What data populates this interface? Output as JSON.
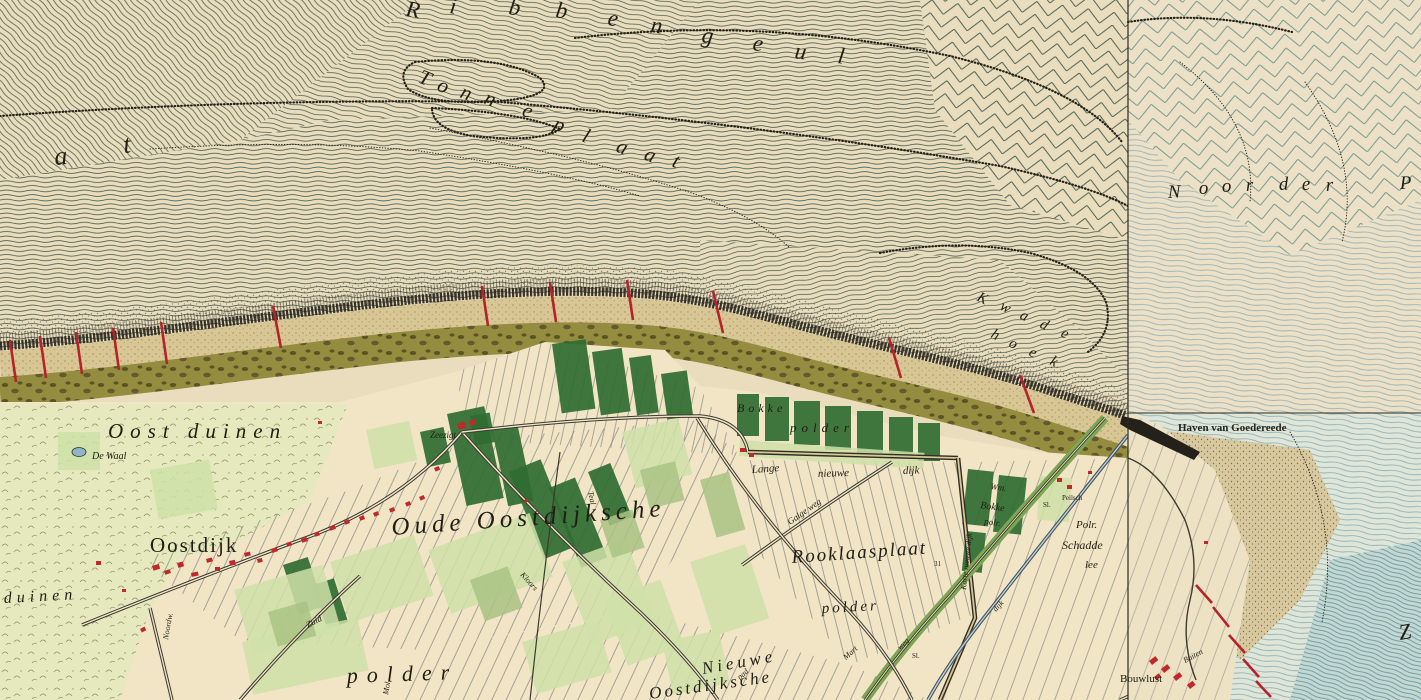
{
  "map": {
    "colors": {
      "paper_sea": "#e9ddbd",
      "paper_right": "#ece0c6",
      "paper_polder": "#f1e5c6",
      "sea_line": "#3a4f47",
      "chevron_right": "#5d8c82",
      "water_blue": "#7fa7b4",
      "water_deep": "#5e94a6",
      "beach": "#d9c695",
      "olive_band": "#948c3e",
      "dune_pale": "#e5e9bd",
      "field_dark": "#2f6c31",
      "field_mid": "#a9c383",
      "field_light": "#cfe0a8",
      "building_red": "#c0282a",
      "groyne_red": "#b5232a",
      "road_dark": "#3b3a30",
      "ink": "#201e13"
    },
    "sea_words": [
      {
        "name": "ribbengeul",
        "size": 23,
        "rot": 8,
        "letters": [
          {
            "t": "R",
            "x": 405,
            "y": 16
          },
          {
            "t": "i",
            "x": 449,
            "y": 13
          },
          {
            "t": "b",
            "x": 508,
            "y": 14
          },
          {
            "t": "b",
            "x": 555,
            "y": 17
          },
          {
            "t": "e",
            "x": 607,
            "y": 25
          },
          {
            "t": "n",
            "x": 650,
            "y": 32
          },
          {
            "t": "g",
            "x": 701,
            "y": 42
          },
          {
            "t": "e",
            "x": 752,
            "y": 50
          },
          {
            "t": "u",
            "x": 794,
            "y": 58
          },
          {
            "t": "l",
            "x": 837,
            "y": 63
          }
        ]
      },
      {
        "name": "tonneplaat",
        "size": 21,
        "rot": 22,
        "letters": [
          {
            "t": "T",
            "x": 417,
            "y": 82
          },
          {
            "t": "o",
            "x": 436,
            "y": 90
          },
          {
            "t": "n",
            "x": 459,
            "y": 97
          },
          {
            "t": "n",
            "x": 483,
            "y": 103
          },
          {
            "t": "e",
            "x": 521,
            "y": 115
          },
          {
            "t": "p",
            "x": 552,
            "y": 129
          },
          {
            "t": "l",
            "x": 581,
            "y": 141
          },
          {
            "t": "a",
            "x": 615,
            "y": 151
          },
          {
            "t": "a",
            "x": 643,
            "y": 159
          },
          {
            "t": "t",
            "x": 671,
            "y": 166
          }
        ]
      },
      {
        "name": "plaat-at",
        "size": 26,
        "rot": -5,
        "letters": [
          {
            "t": "a",
            "x": 55,
            "y": 165
          },
          {
            "t": "t",
            "x": 124,
            "y": 153
          }
        ]
      },
      {
        "name": "noorder-p",
        "size": 19,
        "rot": -2,
        "letters": [
          {
            "t": "N",
            "x": 1168,
            "y": 198
          },
          {
            "t": "o",
            "x": 1199,
            "y": 194
          },
          {
            "t": "o",
            "x": 1222,
            "y": 192
          },
          {
            "t": "r",
            "x": 1246,
            "y": 191
          },
          {
            "t": "d",
            "x": 1279,
            "y": 190
          },
          {
            "t": "e",
            "x": 1302,
            "y": 190
          },
          {
            "t": "r",
            "x": 1326,
            "y": 191
          },
          {
            "t": "P",
            "x": 1400,
            "y": 189
          }
        ]
      },
      {
        "name": "kwade-hoek",
        "size": 15,
        "rot": 27,
        "letters": [
          {
            "t": "K",
            "x": 976,
            "y": 300
          },
          {
            "t": "w",
            "x": 999,
            "y": 309
          },
          {
            "t": "a",
            "x": 1019,
            "y": 318
          },
          {
            "t": "d",
            "x": 1039,
            "y": 327
          },
          {
            "t": "e",
            "x": 1060,
            "y": 336
          },
          {
            "t": "h",
            "x": 990,
            "y": 337
          },
          {
            "t": "o",
            "x": 1008,
            "y": 346
          },
          {
            "t": "e",
            "x": 1028,
            "y": 355
          },
          {
            "t": "k",
            "x": 1049,
            "y": 364
          }
        ]
      }
    ],
    "labels": [
      {
        "t": "Oost duinen",
        "x": 108,
        "y": 438,
        "s": 21,
        "ls": 7
      },
      {
        "t": "De Waal",
        "x": 92,
        "y": 459,
        "s": 10
      },
      {
        "t": "Oostdijk",
        "x": 150,
        "y": 552,
        "s": 21,
        "ls": 2,
        "c": "u"
      },
      {
        "t": "Oude Oostdijksche",
        "x": 392,
        "y": 535,
        "s": 25,
        "ls": 5,
        "r": -4
      },
      {
        "t": "Rooklaasplaat",
        "x": 792,
        "y": 563,
        "s": 19,
        "ls": 2,
        "r": -4
      },
      {
        "t": "polder",
        "x": 822,
        "y": 613,
        "s": 15,
        "ls": 3,
        "r": -3
      },
      {
        "t": "polder",
        "x": 347,
        "y": 683,
        "s": 22,
        "ls": 9,
        "r": -2
      },
      {
        "t": "Nieuwe",
        "x": 703,
        "y": 674,
        "s": 17,
        "ls": 4,
        "r": -10
      },
      {
        "t": "Oostdijksche",
        "x": 650,
        "y": 699,
        "s": 17,
        "ls": 3,
        "r": -8
      },
      {
        "t": "duinen",
        "x": 4,
        "y": 603,
        "s": 16,
        "ls": 5,
        "r": -3
      },
      {
        "t": "Zeezigt",
        "x": 430,
        "y": 438,
        "s": 9
      },
      {
        "t": "Lange",
        "x": 752,
        "y": 473,
        "s": 11,
        "r": -4
      },
      {
        "t": "nieuwe",
        "x": 818,
        "y": 477,
        "s": 11,
        "r": -2
      },
      {
        "t": "dijk",
        "x": 903,
        "y": 474,
        "s": 11,
        "r": -2
      },
      {
        "t": "Galge weg",
        "x": 790,
        "y": 525,
        "s": 9,
        "r": -35
      },
      {
        "t": "Korte nieuwe dijk",
        "x": 966,
        "y": 590,
        "s": 8,
        "r": -84
      },
      {
        "t": "Wm.",
        "x": 990,
        "y": 489,
        "s": 9,
        "r": 8
      },
      {
        "t": "Bokke",
        "x": 980,
        "y": 508,
        "s": 10,
        "r": 8
      },
      {
        "t": "polr.",
        "x": 984,
        "y": 524,
        "s": 9,
        "r": 8
      },
      {
        "t": "Bokke",
        "x": 737,
        "y": 412,
        "s": 12,
        "ls": 4
      },
      {
        "t": "polder",
        "x": 790,
        "y": 432,
        "s": 13,
        "ls": 5
      },
      {
        "t": "Polr.",
        "x": 1076,
        "y": 528,
        "s": 11
      },
      {
        "t": "Schadde",
        "x": 1062,
        "y": 549,
        "s": 12
      },
      {
        "t": "lee",
        "x": 1085,
        "y": 568,
        "s": 11
      },
      {
        "t": "Peilsch",
        "x": 1062,
        "y": 500,
        "s": 7,
        "c": "t"
      },
      {
        "t": "Sl.",
        "x": 1043,
        "y": 507,
        "s": 7,
        "c": "t"
      },
      {
        "t": "31",
        "x": 934,
        "y": 566,
        "s": 7,
        "c": "t"
      },
      {
        "t": "Sl.",
        "x": 912,
        "y": 658,
        "s": 7,
        "c": "t"
      },
      {
        "t": "dijk",
        "x": 996,
        "y": 612,
        "s": 8,
        "r": -48
      },
      {
        "t": "Bouwlust",
        "x": 1120,
        "y": 682,
        "s": 11,
        "c": "u"
      },
      {
        "t": "Buiten",
        "x": 1185,
        "y": 663,
        "s": 8,
        "r": -28
      },
      {
        "t": "Haven van Goedereede",
        "x": 1178,
        "y": 431,
        "s": 11,
        "c": "b"
      },
      {
        "t": "Zuid",
        "x": 308,
        "y": 628,
        "s": 9,
        "r": -28
      },
      {
        "t": "Noordw.",
        "x": 168,
        "y": 640,
        "s": 8,
        "r": -80
      },
      {
        "t": "Mol.",
        "x": 388,
        "y": 695,
        "s": 8,
        "r": -80
      },
      {
        "t": "Kloors",
        "x": 520,
        "y": 575,
        "s": 8,
        "r": 48
      },
      {
        "t": "Teal",
        "x": 588,
        "y": 492,
        "s": 8,
        "r": 78
      },
      {
        "t": "pad",
        "x": 740,
        "y": 680,
        "s": 8,
        "r": -42
      },
      {
        "t": "Mart",
        "x": 846,
        "y": 660,
        "s": 8,
        "r": -42
      },
      {
        "t": "weg",
        "x": 900,
        "y": 650,
        "s": 8,
        "r": -42
      },
      {
        "t": "Z",
        "x": 1400,
        "y": 640,
        "s": 22,
        "r": -10
      }
    ],
    "groynes": [
      [
        10,
        340,
        16,
        382
      ],
      [
        40,
        336,
        46,
        378
      ],
      [
        76,
        332,
        82,
        374
      ],
      [
        113,
        328,
        119,
        370
      ],
      [
        161,
        322,
        167,
        364
      ],
      [
        273,
        306,
        281,
        348
      ],
      [
        482,
        286,
        488,
        326
      ],
      [
        550,
        282,
        556,
        322
      ],
      [
        627,
        280,
        633,
        320
      ],
      [
        713,
        291,
        723,
        333
      ],
      [
        889,
        338,
        901,
        378
      ],
      [
        1020,
        375,
        1034,
        413
      ],
      [
        1196,
        585,
        1212,
        603
      ],
      [
        1213,
        607,
        1229,
        627
      ],
      [
        1229,
        635,
        1245,
        653
      ],
      [
        1243,
        659,
        1259,
        677
      ],
      [
        1256,
        681,
        1271,
        697
      ]
    ],
    "buildings": [
      [
        152,
        566,
        7,
        5,
        -18
      ],
      [
        164,
        571,
        6,
        4,
        -18
      ],
      [
        177,
        563,
        6,
        5,
        -15
      ],
      [
        191,
        573,
        7,
        4,
        -12
      ],
      [
        206,
        559,
        6,
        4,
        -15
      ],
      [
        215,
        567,
        5,
        4,
        0
      ],
      [
        229,
        561,
        6,
        5,
        -12
      ],
      [
        244,
        553,
        6,
        4,
        -15
      ],
      [
        257,
        559,
        5,
        4,
        -12
      ],
      [
        271,
        549,
        6,
        4,
        -16
      ],
      [
        286,
        543,
        5,
        4,
        -18
      ],
      [
        301,
        539,
        6,
        4,
        -18
      ],
      [
        314,
        533,
        5,
        4,
        -18
      ],
      [
        329,
        527,
        6,
        4,
        -20
      ],
      [
        344,
        521,
        5,
        4,
        -20
      ],
      [
        359,
        517,
        5,
        4,
        -20
      ],
      [
        373,
        513,
        5,
        4,
        -22
      ],
      [
        389,
        509,
        5,
        4,
        -24
      ],
      [
        405,
        503,
        5,
        4,
        -24
      ],
      [
        419,
        497,
        5,
        4,
        -24
      ],
      [
        434,
        468,
        5,
        4,
        -24
      ],
      [
        457,
        424,
        8,
        6,
        -18
      ],
      [
        469,
        421,
        6,
        5,
        -18
      ],
      [
        740,
        448,
        6,
        4,
        0
      ],
      [
        749,
        453,
        5,
        4,
        0
      ],
      [
        1057,
        478,
        5,
        4,
        0
      ],
      [
        1067,
        485,
        5,
        4,
        0
      ],
      [
        1088,
        471,
        4,
        3,
        0
      ],
      [
        1204,
        541,
        4,
        3,
        0
      ],
      [
        1149,
        661,
        8,
        5,
        -38
      ],
      [
        1161,
        669,
        8,
        5,
        -38
      ],
      [
        1173,
        677,
        8,
        5,
        -38
      ],
      [
        1187,
        685,
        7,
        5,
        -38
      ],
      [
        1154,
        677,
        6,
        4,
        -38
      ],
      [
        96,
        561,
        5,
        4,
        0
      ],
      [
        140,
        629,
        5,
        4,
        -28
      ],
      [
        122,
        589,
        4,
        3,
        0
      ],
      [
        524,
        500,
        4,
        3,
        -20
      ],
      [
        318,
        421,
        4,
        3,
        0
      ]
    ],
    "fields": [
      [
        447,
        414,
        38,
        94,
        -12,
        "d"
      ],
      [
        492,
        430,
        26,
        78,
        -12,
        "d"
      ],
      [
        552,
        344,
        34,
        70,
        -8,
        "d"
      ],
      [
        592,
        352,
        30,
        64,
        -8,
        "d"
      ],
      [
        629,
        358,
        22,
        58,
        -8,
        "d"
      ],
      [
        661,
        374,
        26,
        46,
        -8,
        "d"
      ],
      [
        737,
        394,
        22,
        42,
        0,
        "d"
      ],
      [
        765,
        397,
        24,
        44,
        0,
        "d"
      ],
      [
        794,
        401,
        26,
        44,
        0,
        "d"
      ],
      [
        825,
        406,
        26,
        44,
        0,
        "d"
      ],
      [
        857,
        411,
        26,
        42,
        0,
        "d"
      ],
      [
        889,
        417,
        24,
        40,
        0,
        "d"
      ],
      [
        918,
        423,
        22,
        38,
        0,
        "d"
      ],
      [
        509,
        472,
        34,
        94,
        -22,
        "d"
      ],
      [
        549,
        488,
        28,
        86,
        -22,
        "d"
      ],
      [
        588,
        472,
        24,
        58,
        -22,
        "d"
      ],
      [
        968,
        469,
        26,
        55,
        6,
        "d"
      ],
      [
        999,
        475,
        28,
        57,
        6,
        "d"
      ],
      [
        966,
        531,
        20,
        40,
        6,
        "d"
      ],
      [
        470,
        416,
        20,
        30,
        -10,
        "d"
      ],
      [
        420,
        432,
        24,
        36,
        -12,
        "d"
      ],
      [
        283,
        565,
        26,
        52,
        -18,
        "d"
      ],
      [
        313,
        585,
        22,
        46,
        -18,
        "d"
      ],
      [
        234,
        590,
        92,
        68,
        -16,
        "l"
      ],
      [
        330,
        562,
        88,
        64,
        -18,
        "l"
      ],
      [
        428,
        550,
        108,
        68,
        -20,
        "l"
      ],
      [
        242,
        642,
        118,
        54,
        -12,
        "l"
      ],
      [
        562,
        562,
        68,
        88,
        -20,
        "l"
      ],
      [
        622,
        432,
        58,
        58,
        -14,
        "l"
      ],
      [
        690,
        562,
        58,
        78,
        -18,
        "l"
      ],
      [
        522,
        642,
        78,
        54,
        -16,
        "l"
      ],
      [
        662,
        642,
        58,
        54,
        -12,
        "l"
      ],
      [
        58,
        432,
        42,
        38,
        0,
        "l"
      ],
      [
        740,
        440,
        185,
        16,
        4,
        "l"
      ],
      [
        604,
        600,
        60,
        70,
        -20,
        "l"
      ],
      [
        150,
        470,
        60,
        50,
        -10,
        "l"
      ],
      [
        366,
        430,
        44,
        40,
        -12,
        "l"
      ],
      [
        1040,
        476,
        32,
        44,
        4,
        "l"
      ],
      [
        1130,
        596,
        26,
        40,
        -30,
        "l"
      ],
      [
        268,
        612,
        40,
        36,
        -16,
        "m"
      ],
      [
        470,
        580,
        40,
        44,
        -20,
        "m"
      ],
      [
        640,
        470,
        36,
        40,
        -14,
        "m"
      ],
      [
        600,
        520,
        34,
        40,
        -18,
        "m"
      ],
      [
        700,
        480,
        30,
        60,
        -16,
        "m"
      ],
      [
        1130,
        642,
        30,
        20,
        -38,
        "m"
      ]
    ],
    "roads": [
      {
        "d": "M82,625 Q180,585 300,540 Q400,505 462,432",
        "s": "road"
      },
      {
        "d": "M462,432 Q540,520 640,612 Q690,660 718,700",
        "s": "road"
      },
      {
        "d": "M462,432 Q600,416 700,416 Q742,420 748,452",
        "s": "road"
      },
      {
        "d": "M748,452 L958,458",
        "s": "dike"
      },
      {
        "d": "M958,458 L975,618 L940,700",
        "s": "dike"
      },
      {
        "d": "M1105,418 Q1030,500 950,595 Q900,650 865,700",
        "s": "greendike"
      },
      {
        "d": "M1128,435 Q1060,520 990,610 Q950,660 928,700",
        "s": "canal"
      },
      {
        "d": "M742,565 Q810,515 892,462",
        "s": "road"
      },
      {
        "d": "M697,418 Q760,520 850,612 Q890,655 912,700",
        "s": "road"
      },
      {
        "d": "M150,608 L172,700",
        "s": "road"
      },
      {
        "d": "M240,700 Q300,630 360,576",
        "s": "road"
      },
      {
        "d": "M1120,700 L1280,628",
        "s": "road"
      },
      {
        "d": "M1142,700 L1302,640",
        "s": "path"
      },
      {
        "d": "M560,452 Q545,560 530,700",
        "s": "path"
      }
    ]
  }
}
